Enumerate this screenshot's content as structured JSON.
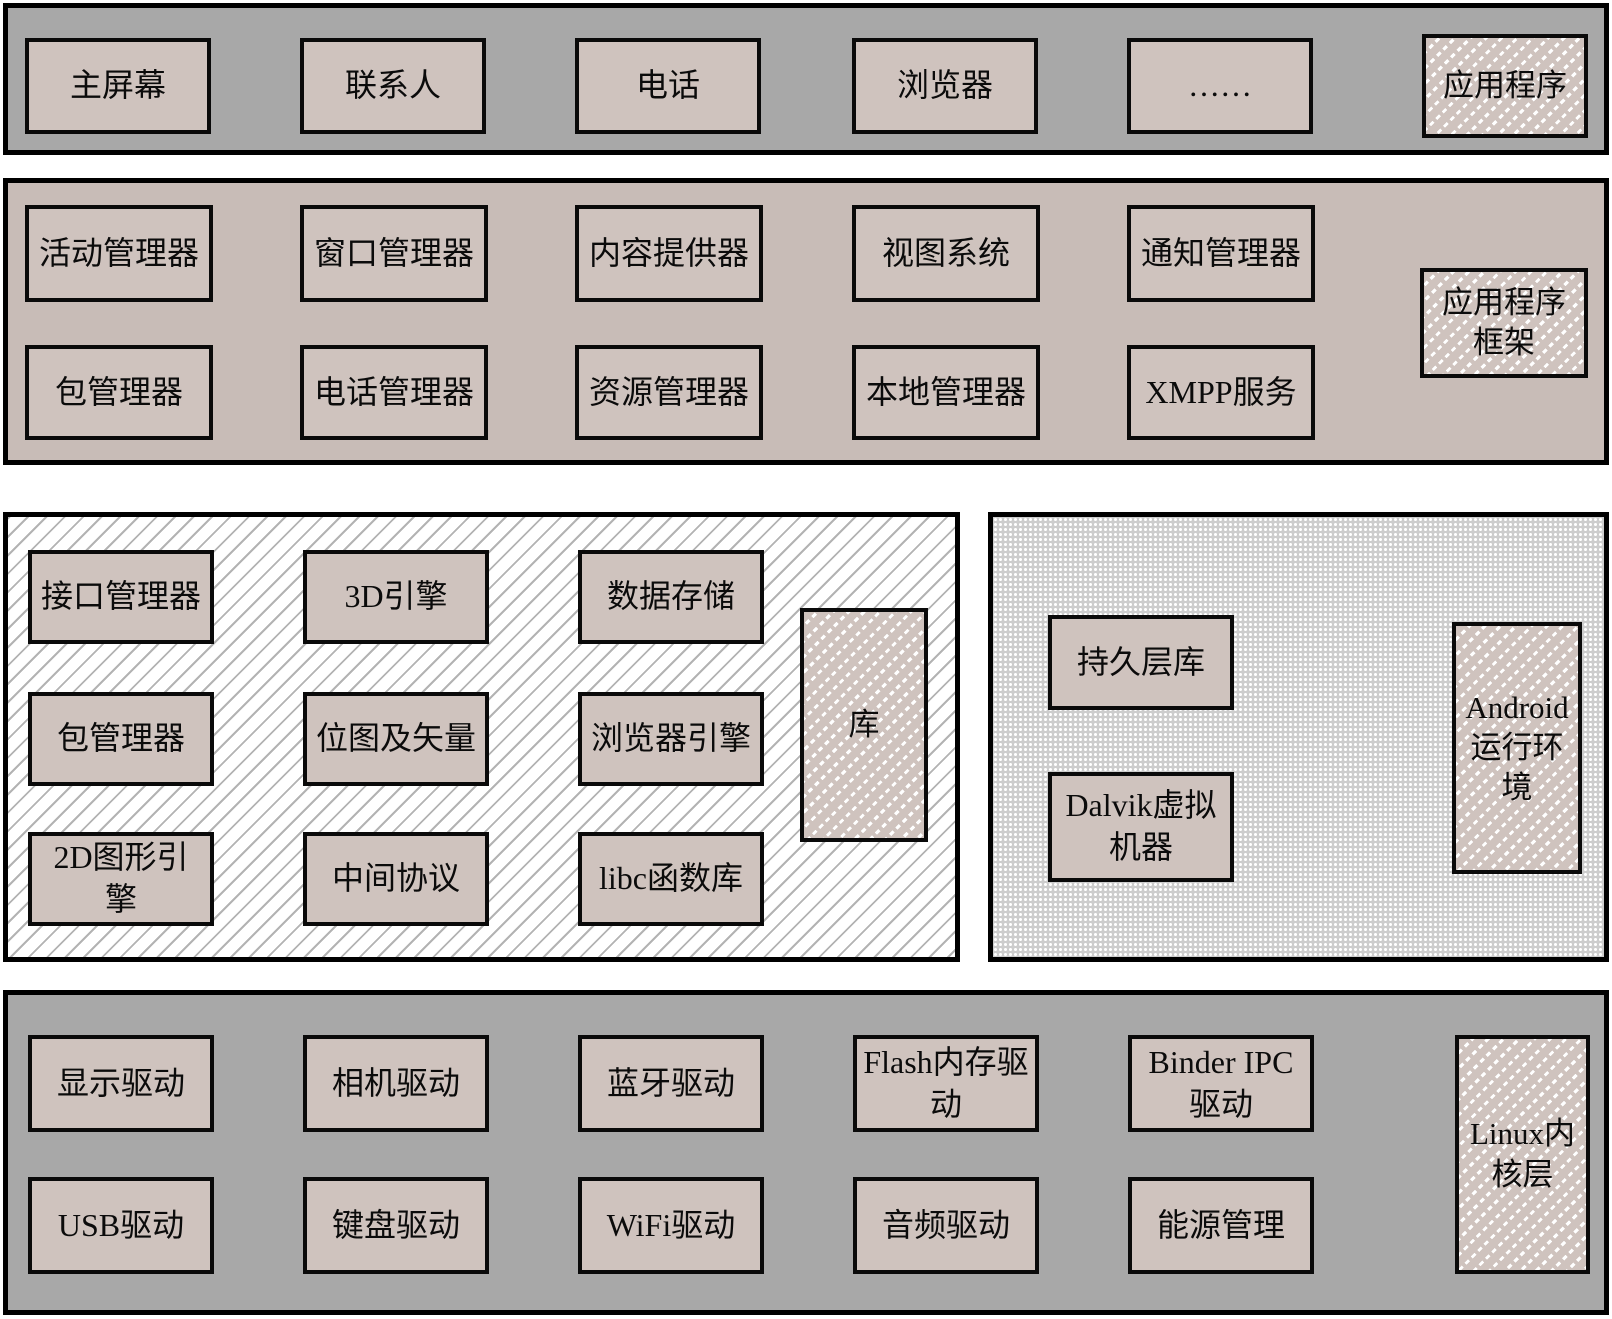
{
  "title": "Android系统架构图",
  "colors": {
    "band_gray": "#a8a8a8",
    "band_pink": "#c8bcb7",
    "box_fill": "#cfc3be",
    "border": "#000000",
    "hatch_line": "#b3b3b3",
    "dots_background": "#cdcdcd"
  },
  "layers": {
    "apps": {
      "boxes": [
        "主屏幕",
        "联系人",
        "电话",
        "浏览器",
        "……"
      ],
      "label": "应用程序"
    },
    "framework": {
      "boxes": [
        "活动管理器",
        "窗口管理器",
        "内容提供器",
        "视图系统",
        "通知管理器",
        "包管理器",
        "电话管理器",
        "资源管理器",
        "本地管理器",
        "XMPP服务"
      ],
      "label": "应用程序框架"
    },
    "libraries": {
      "boxes": [
        "接口管理器",
        "3D引擎",
        "数据存储",
        "包管理器",
        "位图及矢量",
        "浏览器引擎",
        "2D图形引擎",
        "中间协议",
        "libc函数库"
      ],
      "label": "库"
    },
    "runtime": {
      "boxes": [
        "持久层库",
        "Dalvik虚拟机器"
      ],
      "label": "Android运行环境"
    },
    "kernel": {
      "boxes": [
        "显示驱动",
        "相机驱动",
        "蓝牙驱动",
        "Flash内存驱动",
        "Binder IPC驱动",
        "USB驱动",
        "键盘驱动",
        "WiFi驱动",
        "音频驱动",
        "能源管理"
      ],
      "label": "Linux内核层"
    }
  }
}
